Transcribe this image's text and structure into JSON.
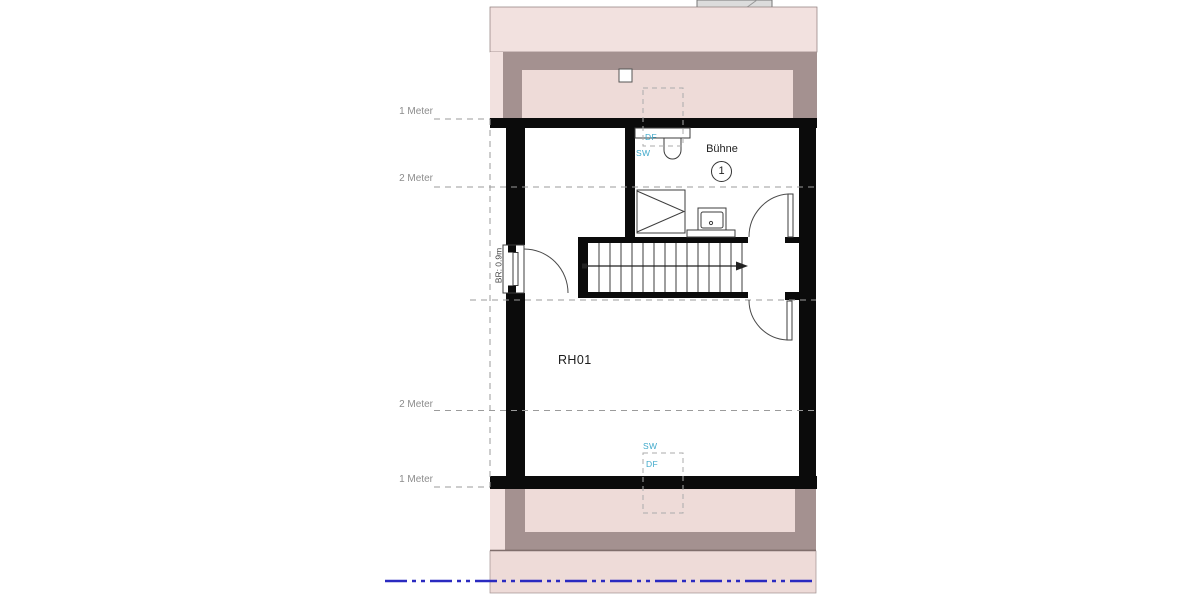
{
  "colors": {
    "pink_light": "#f2e1df",
    "pink_mid": "#eedbd8",
    "mauve": "#a49190",
    "wall": "#0b0b0b",
    "dash_gray": "#9b9b9b",
    "centerline_blue": "#2a2ac0",
    "cyan": "#3fa9cb",
    "label_gray": "#8c8c8c"
  },
  "scale_marks": {
    "top_1m": "1 Meter",
    "top_2m": "2 Meter",
    "bottom_2m": "2 Meter",
    "bottom_1m": "1 Meter"
  },
  "rooms": {
    "buehne": {
      "name": "Bühne",
      "number": "1"
    },
    "rh01": {
      "name": "RH01"
    }
  },
  "door": {
    "width_label": "BR: 0.9m"
  },
  "skylights": {
    "top": {
      "window_label": "DF",
      "opening_label": "SW"
    },
    "bottom": {
      "window_label": "DF",
      "opening_label": "SW"
    }
  }
}
